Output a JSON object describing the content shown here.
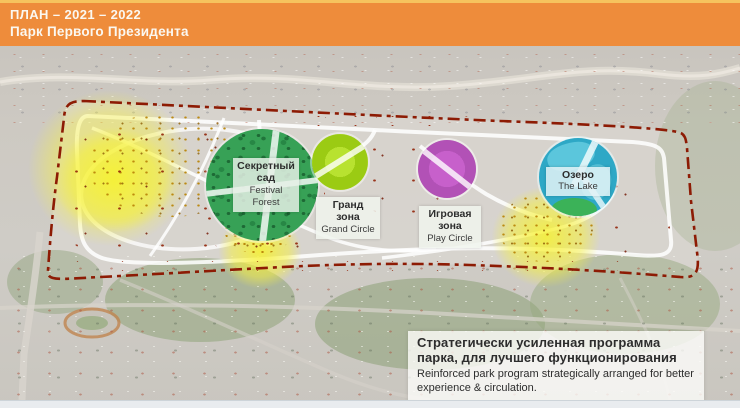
{
  "header": {
    "title_line1": "ПЛАН  – 2021 – 2022",
    "title_line2": "Парк Первого Президента"
  },
  "zones": [
    {
      "id": "festival-forest",
      "ru_line1": "Секретный",
      "ru_line2": "сад",
      "en": "Festival Forest",
      "color": "#37A156"
    },
    {
      "id": "grand-circle",
      "ru_line1": "Гранд",
      "ru_line2": "зона",
      "en": "Grand Circle",
      "color": "#A9D91F"
    },
    {
      "id": "play-circle",
      "ru_line1": "Игровая",
      "ru_line2": "зона",
      "en": "Play Circle",
      "color": "#C25EC6"
    },
    {
      "id": "the-lake",
      "ru_line1": "Озеро",
      "en": "The Lake",
      "color": "#2EA8C6"
    }
  ],
  "info_box": {
    "title_ru": "Стратегически усиленная программа парка, для лучшего функционирования",
    "body_en": "Reinforced park program strategically arranged for better experience & circulation."
  },
  "map": {
    "border_color": "#8D1B04",
    "highlight_color": "#F7F23C",
    "header_bg": "#EE8C3B"
  }
}
